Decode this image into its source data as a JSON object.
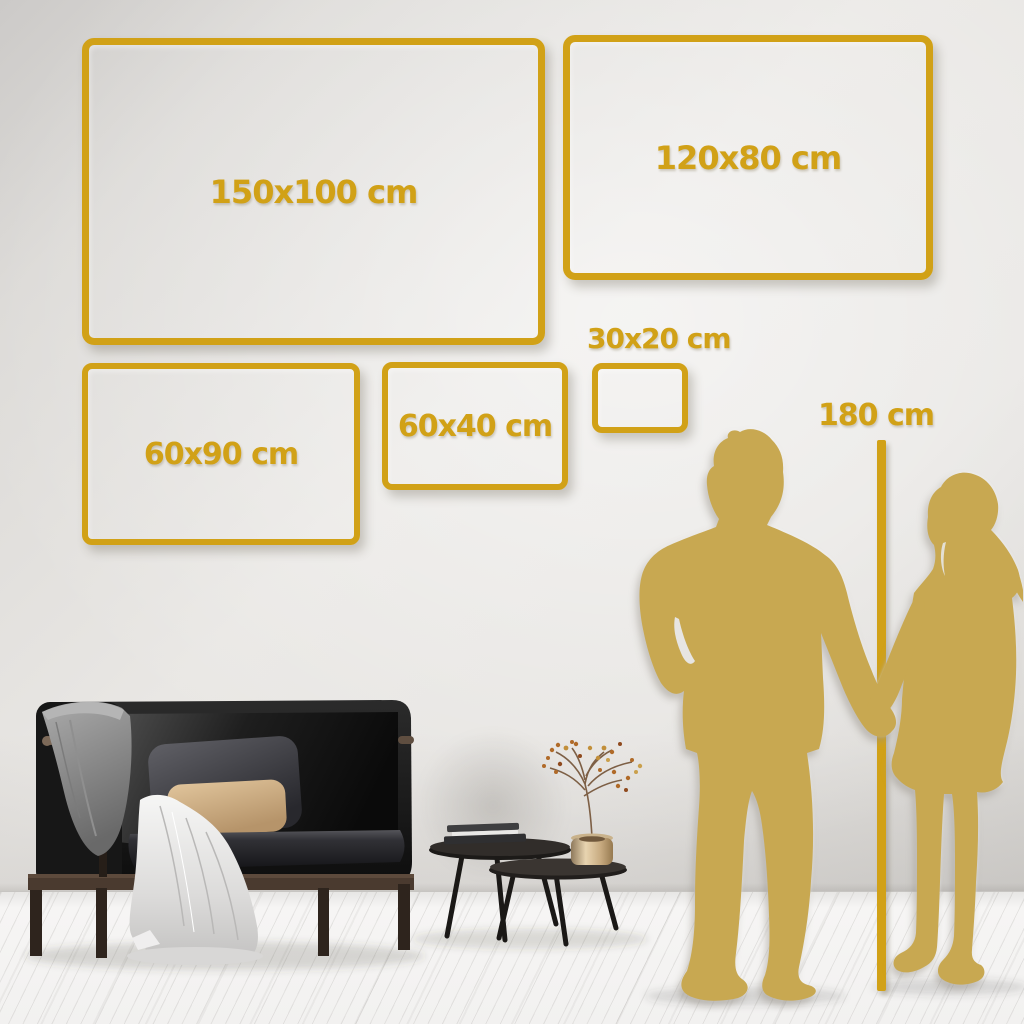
{
  "colors": {
    "accent_gold": "#D1A117",
    "silhouette_gold": "#C8A851",
    "wall": "#E7E5E2",
    "floor": "#F2F1F0"
  },
  "size_frames": [
    {
      "id": "150x100",
      "label": "150x100 cm"
    },
    {
      "id": "120x80",
      "label": "120x80 cm"
    },
    {
      "id": "60x90",
      "label": "60x90 cm"
    },
    {
      "id": "60x40",
      "label": "60x40 cm"
    },
    {
      "id": "30x20",
      "label": "30x20 cm"
    }
  ],
  "height_reference": {
    "label": "180 cm"
  }
}
